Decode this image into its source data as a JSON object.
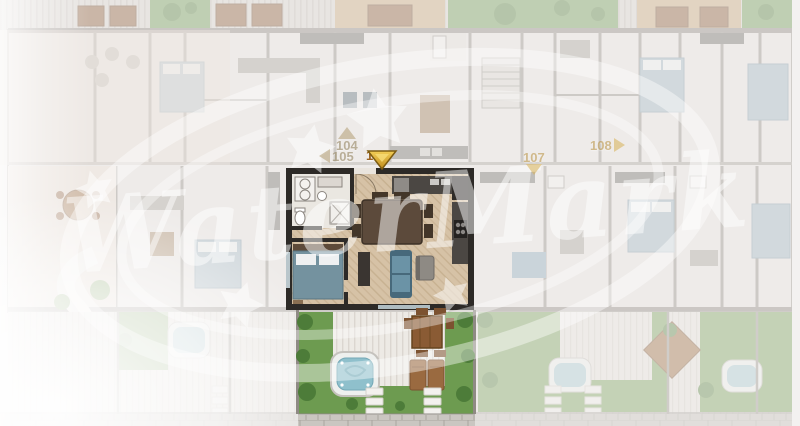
{
  "viewer": {
    "active_unit": "106",
    "watermark": {
      "text": "WaterMark"
    },
    "markers": [
      {
        "label": "104",
        "direction": "up",
        "state": "inactive"
      },
      {
        "label": "105",
        "direction": "left",
        "state": "inactive"
      },
      {
        "label": "106",
        "direction": "down",
        "state": "active"
      },
      {
        "label": "107",
        "direction": "down",
        "state": "inactive"
      },
      {
        "label": "108",
        "direction": "right",
        "state": "inactive"
      }
    ],
    "colors": {
      "marker_active": "#e0a92e",
      "marker_active_text": "#9c6422",
      "marker_inactive": "#b3a184",
      "highlight_wall": "#2d2a27",
      "faded_wall": "#a39d97",
      "floor_wood": "#d6c2a6",
      "lawn": "#6d9b50",
      "hot_tub_water": "#8fc0cc",
      "sofa_blue": "#567f93",
      "walkway": "#c8c4bf",
      "watermark_color": "#ffffff"
    }
  }
}
